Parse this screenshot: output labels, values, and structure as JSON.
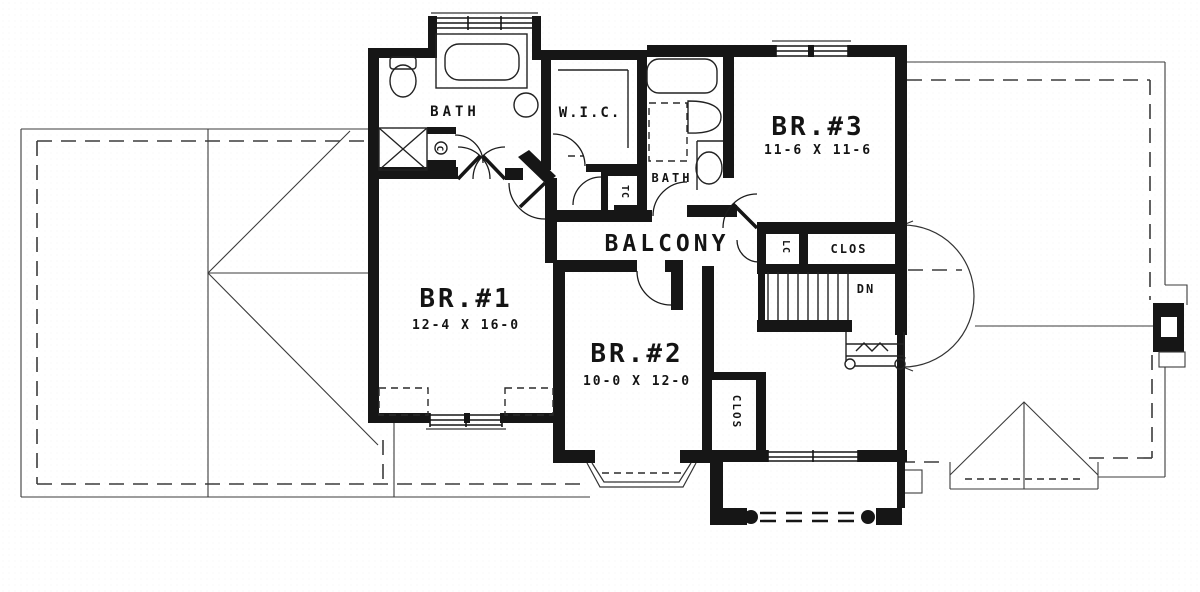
{
  "drawing": {
    "type": "floor-plan",
    "floor": "second-floor",
    "rooms": {
      "bedroom1": {
        "label": "BR.#1",
        "dims": "12-4 X 16-0"
      },
      "bedroom2": {
        "label": "BR.#2",
        "dims": "10-0 X 12-0"
      },
      "bedroom3": {
        "label": "BR.#3",
        "dims": "11-6 X 11-6"
      },
      "balcony": {
        "label": "BALCONY"
      },
      "bath_master": {
        "label": "BATH"
      },
      "bath_hall": {
        "label": "BATH"
      },
      "walk_in_closet": {
        "label": "W.I.C."
      },
      "closet_hall": {
        "label": "CLOS"
      },
      "closet_bedroom2": {
        "label": "CLOS"
      },
      "linen_closet": {
        "label": "LC"
      },
      "toilet_compartment": {
        "label": "TC"
      },
      "small_cabinet": {
        "label": "C"
      }
    },
    "stairs": {
      "direction_label": "DN"
    },
    "colors": {
      "ink": "#161616",
      "paper": "#ffffff"
    }
  }
}
